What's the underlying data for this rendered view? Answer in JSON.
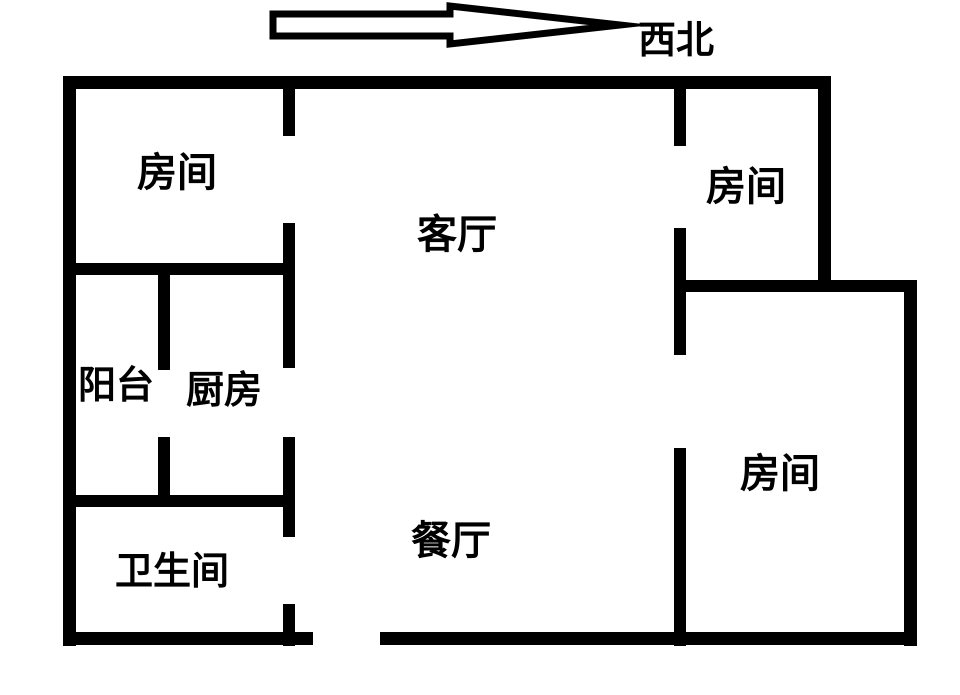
{
  "compass": {
    "label": "西北",
    "arrow_direction": "right"
  },
  "rooms": [
    {
      "name": "bedroom-top-left",
      "label": "房间"
    },
    {
      "name": "living-room",
      "label": "客厅"
    },
    {
      "name": "bedroom-top-right",
      "label": "房间"
    },
    {
      "name": "balcony",
      "label": "阳台"
    },
    {
      "name": "kitchen",
      "label": "厨房"
    },
    {
      "name": "bathroom",
      "label": "卫生间"
    },
    {
      "name": "dining-room",
      "label": "餐厅"
    },
    {
      "name": "bedroom-bottom-right",
      "label": "房间"
    }
  ],
  "colors": {
    "wall": "#000000",
    "background": "#ffffff",
    "text": "#000000"
  }
}
